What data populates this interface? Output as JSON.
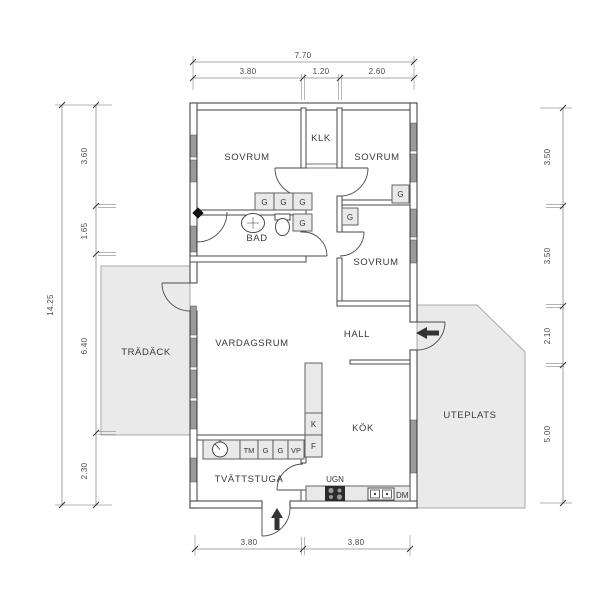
{
  "plan": {
    "rooms": {
      "sovrum1": "SOVRUM",
      "klk": "KLK",
      "sovrum2": "SOVRUM",
      "bad": "BAD",
      "sovrum3": "SOVRUM",
      "vardagsrum": "VARDAGSRUM",
      "hall": "HALL",
      "kok": "KÖK",
      "tvattstuga": "TVÄTTSTUGA",
      "tradack": "TRÄDÄCK",
      "uteplats": "UTEPLATS"
    },
    "fixtures": {
      "g": "G",
      "tm": "TM",
      "vp": "VP",
      "k": "K",
      "f": "F",
      "ugn": "UGN",
      "dm": "DM"
    },
    "dimensions": {
      "top": {
        "total": "7.70",
        "segments": [
          "3.80",
          "1.20",
          "2.60"
        ]
      },
      "left": {
        "total": "14.25",
        "segments": [
          "3.60",
          "1.65",
          "6.40",
          "2.30"
        ]
      },
      "right": {
        "segments": [
          "3.50",
          "3.50",
          "2.10",
          "5.00"
        ]
      },
      "bottom": {
        "segments": [
          "3.80",
          "3.80"
        ]
      }
    },
    "colors": {
      "wall_stroke": "#4a4a4a",
      "window_fill": "#9a9a9a",
      "outdoor_fill": "#eaeaea",
      "cabinet_fill": "#e9e9e9",
      "stove_fill": "#2b2b2b"
    }
  }
}
